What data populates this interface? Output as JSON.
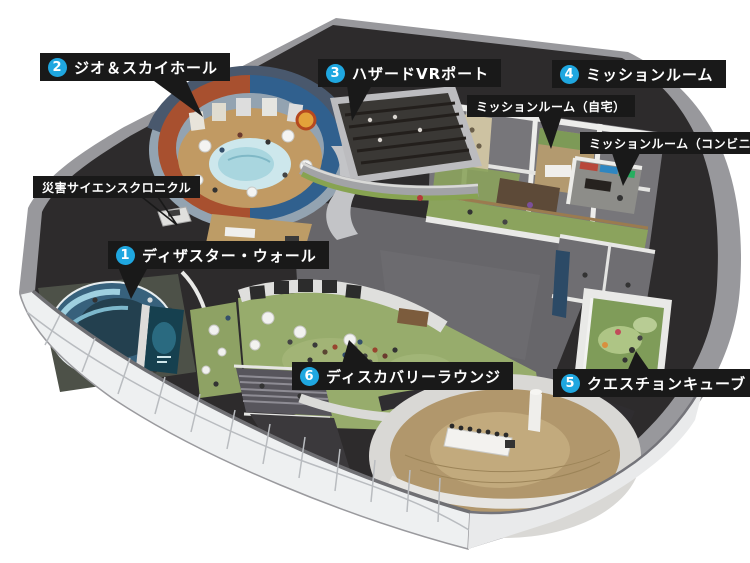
{
  "legend": {
    "numbered": [
      {
        "number": "1",
        "label": "ディザスター・ウォール"
      },
      {
        "number": "2",
        "label": "ジオ＆スカイホール"
      },
      {
        "number": "3",
        "label": "ハザードVRポート"
      },
      {
        "number": "4",
        "label": "ミッションルーム"
      },
      {
        "number": "5",
        "label": "クエスチョンキューブ"
      },
      {
        "number": "6",
        "label": "ディスカバリーラウンジ"
      }
    ],
    "plain": [
      {
        "label": "災害サイエンスクロニクル"
      },
      {
        "label": "ミッションルーム（自宅）"
      },
      {
        "label": "ミッションルーム（コンビニ）"
      }
    ]
  },
  "colors": {
    "label_bg": "#191919",
    "label_text": "#ffffff",
    "badge_blue": "#1fa7e0",
    "roof_dark": "#2d2b2c",
    "rim_gray": "#98989c",
    "facade_white": "#eef0f1",
    "floor_gray": "#67666a",
    "floor_green": "#97ac6c",
    "floor_wood": "#b1976c",
    "hall_wall_red": "#a8502f",
    "hall_wall_blue": "#30608e",
    "hall_floor_tan": "#c19a63",
    "screen_blue": "#5e93ad"
  }
}
